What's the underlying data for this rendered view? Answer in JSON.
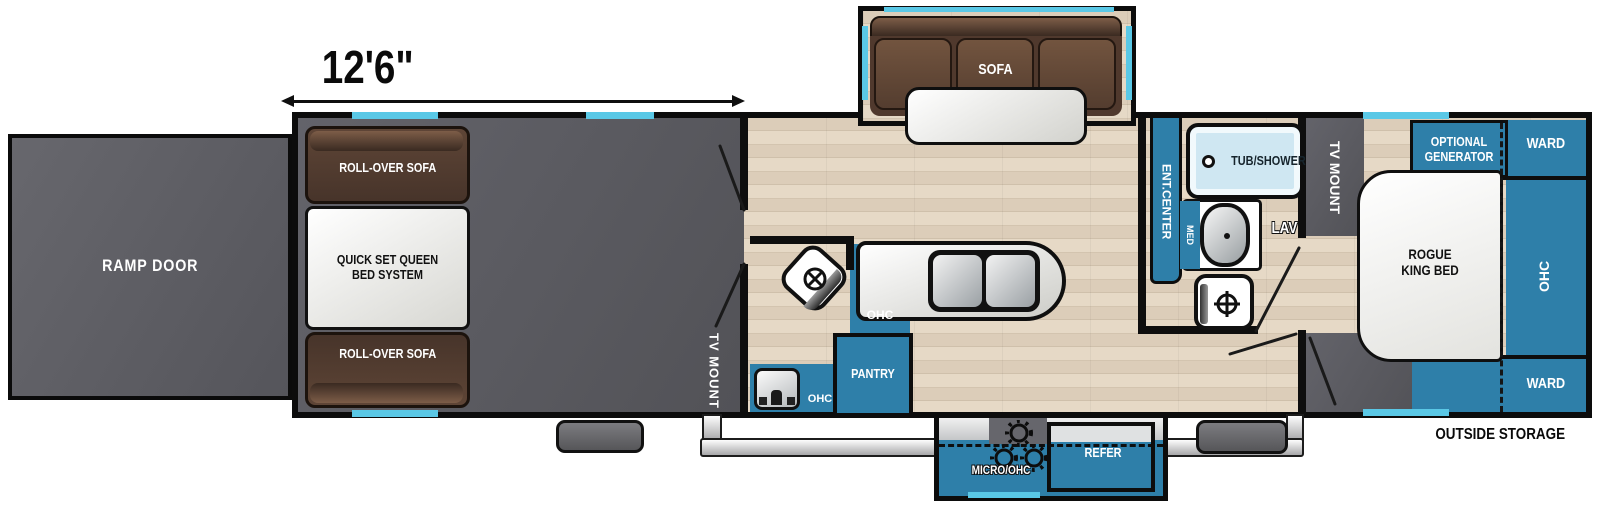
{
  "dimension": {
    "label": "12'6\""
  },
  "ramp": {
    "label": "RAMP DOOR"
  },
  "garage": {
    "rollover_sofa_top": "ROLL-OVER SOFA",
    "queen_bed": "QUICK SET QUEEN BED SYSTEM",
    "rollover_sofa_bottom": "ROLL-OVER SOFA",
    "tv_mount": "TV MOUNT"
  },
  "living": {
    "sofa": "SOFA",
    "ohc_upper": "OHC",
    "pantry": "PANTRY",
    "ohc_bath": "OHC"
  },
  "bath": {
    "ent_center": "ENT.CENTER",
    "tub_shower": "TUB/SHOWER",
    "med": "MED",
    "lav": "LAV"
  },
  "bedroom": {
    "tv_mount": "TV MOUNT",
    "optional_generator": "OPTIONAL GENERATOR",
    "ward_front": "WARD",
    "king_bed": "ROGUE KING BED",
    "ohc": "OHC",
    "ward_rear": "WARD"
  },
  "exterior": {
    "outside_storage": "OUTSIDE STORAGE",
    "micro_ohc": "MICRO/OHC",
    "refer": "REFER"
  },
  "colors": {
    "cabinet_blue": "#2e7fa9",
    "window_cyan": "#5ac8e6",
    "wall_black": "#0e0e0e",
    "garage_gray": "#5a5a5f",
    "sofa_brown": "#5d4535",
    "wood_beige": "#d8c9b5"
  }
}
